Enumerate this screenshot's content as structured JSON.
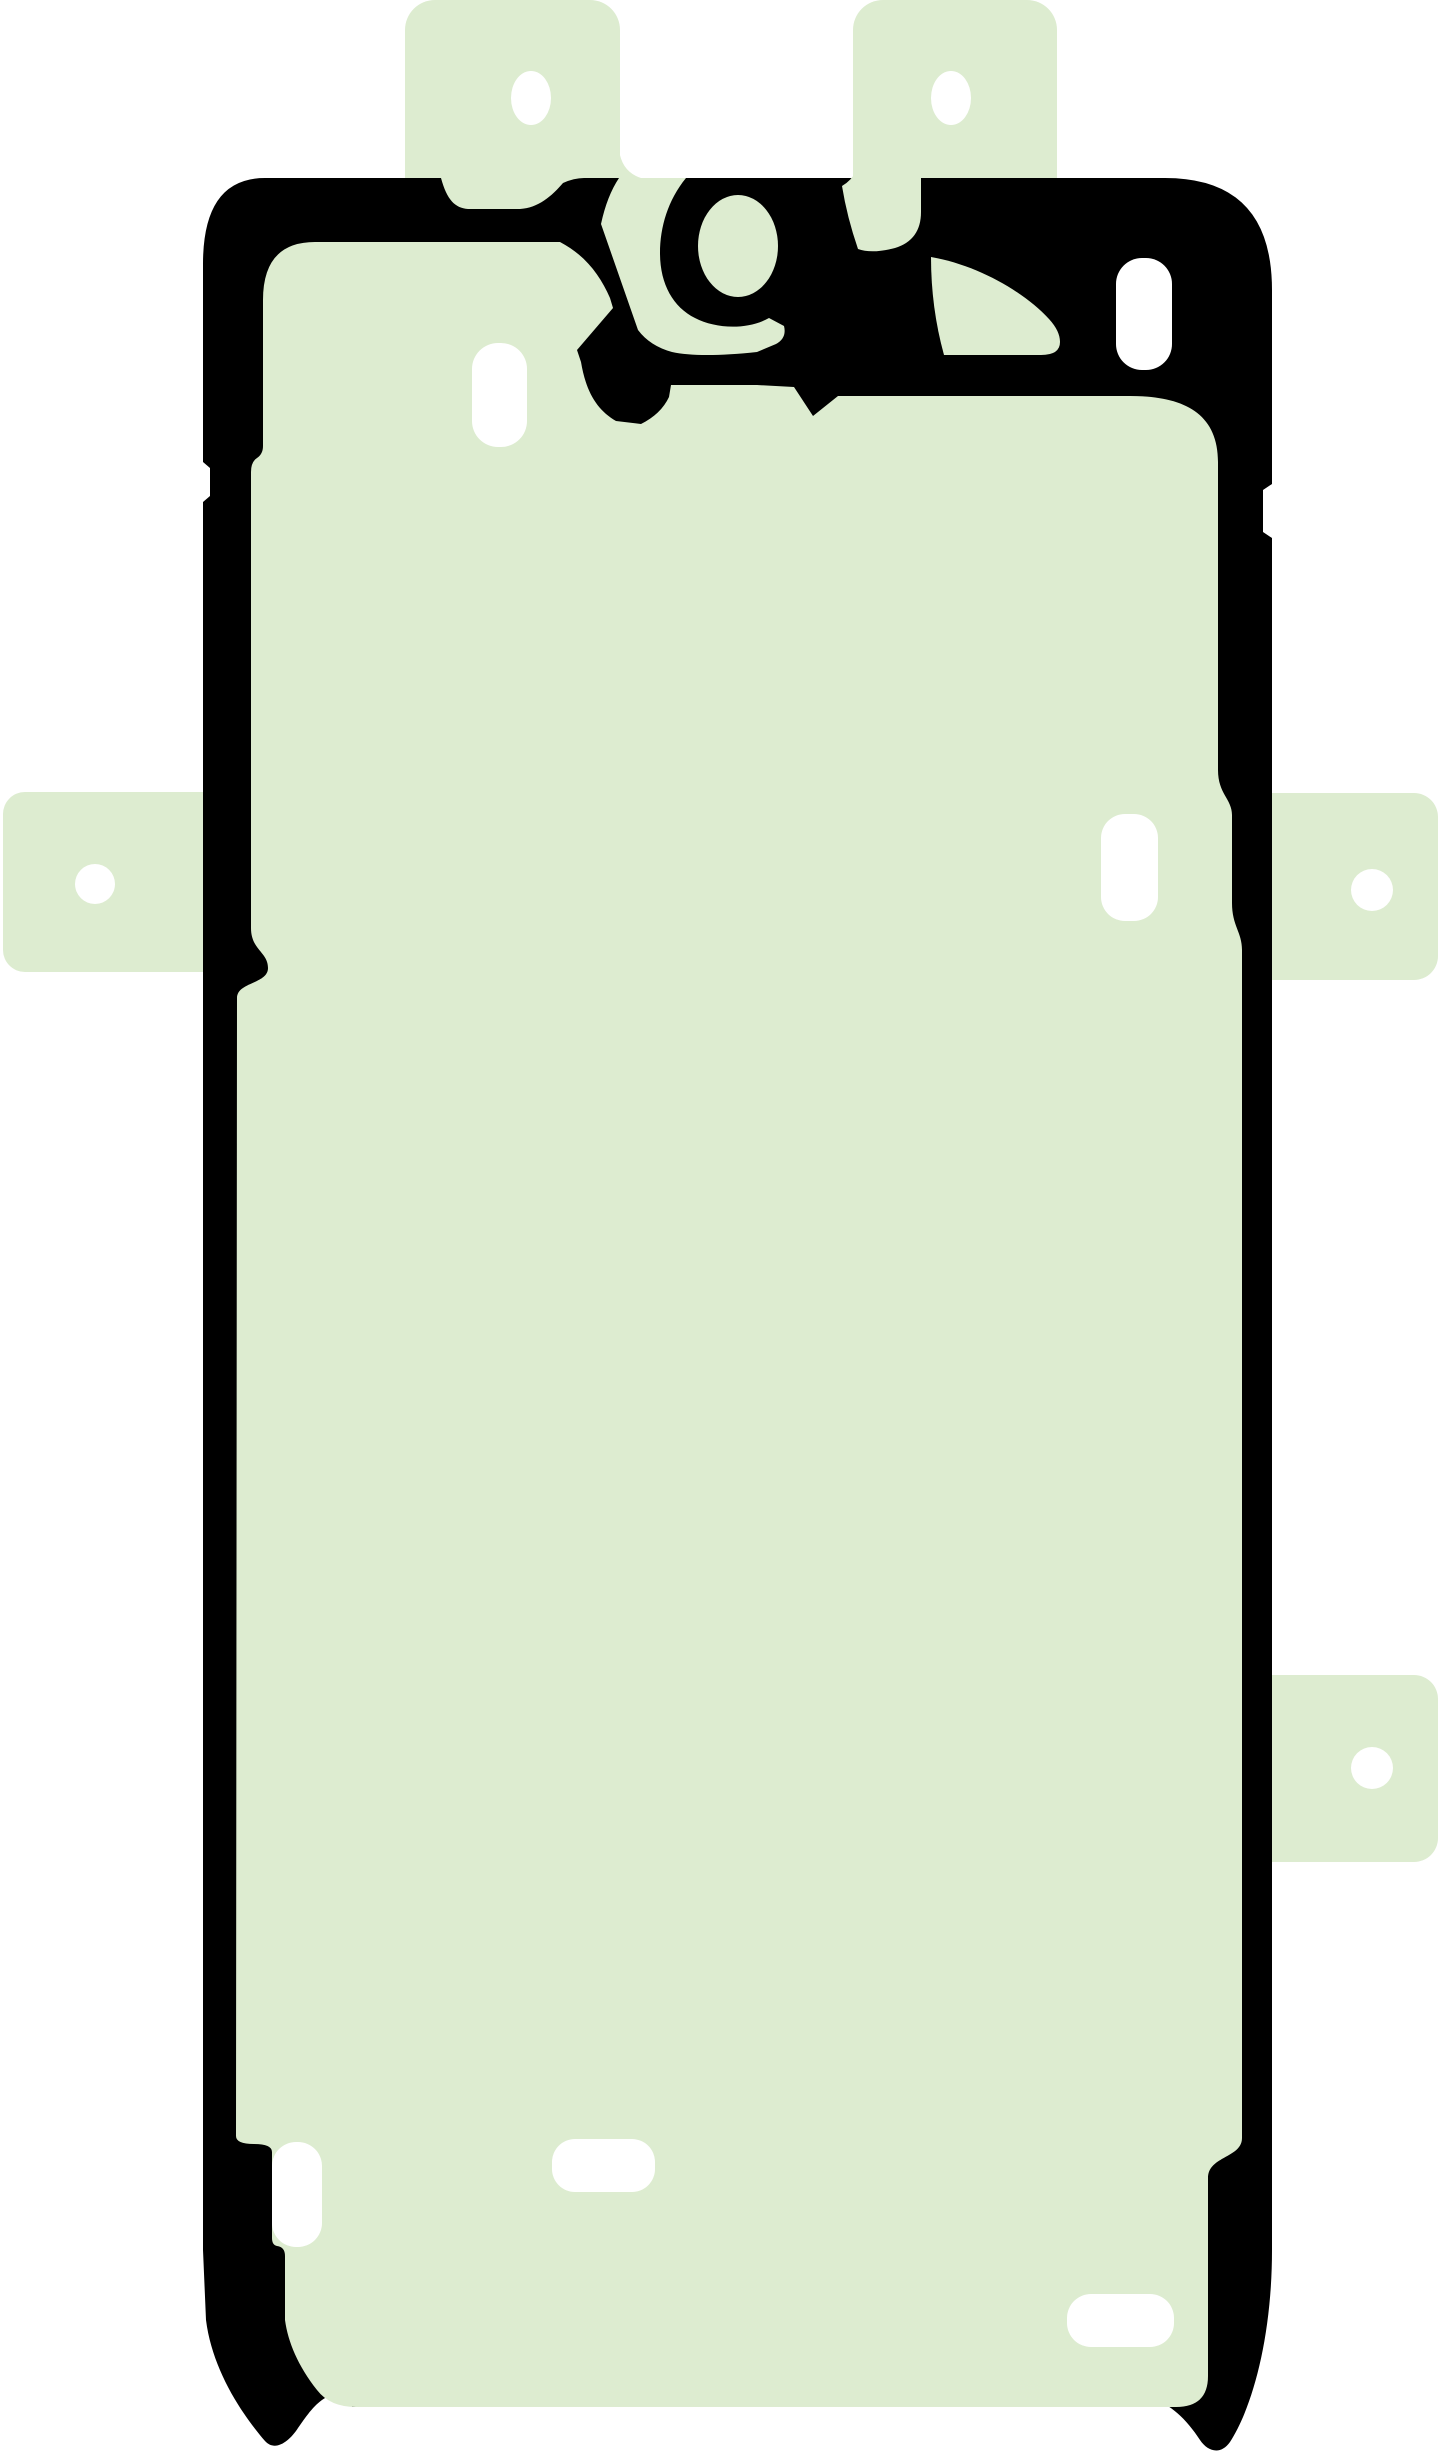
{
  "image": {
    "width": 1445,
    "height": 2452,
    "background": "#ffffff",
    "description": "Product image of a smartphone display adhesive sticker: pale green film with black gasket outline, protruding alignment tabs with punched holes, and white die-cut slots"
  },
  "colors": {
    "film_green": "#ddecd0",
    "gasket_black": "#000000",
    "cutout_white": "#ffffff"
  },
  "sticker": {
    "tabs": [
      {
        "name": "tab-top-left",
        "x": 405,
        "y": 0,
        "w": 215,
        "h": 260,
        "rx": 30
      },
      {
        "name": "tab-top-right",
        "x": 853,
        "y": 0,
        "w": 204,
        "h": 260,
        "rx": 30
      },
      {
        "name": "tab-left-middle",
        "x": 3,
        "y": 792,
        "w": 250,
        "h": 180,
        "rx": 22
      },
      {
        "name": "tab-right-middle",
        "x": 1232,
        "y": 793,
        "w": 206,
        "h": 187,
        "rx": 24
      },
      {
        "name": "tab-right-lower",
        "x": 1232,
        "y": 1675,
        "w": 206,
        "h": 187,
        "rx": 24
      }
    ],
    "tab_holes": [
      {
        "name": "hole-top-left",
        "cx": 531,
        "cy": 98,
        "rx": 20,
        "ry": 27
      },
      {
        "name": "hole-top-right",
        "cx": 951,
        "cy": 98,
        "rx": 20,
        "ry": 27
      },
      {
        "name": "hole-left-middle",
        "cx": 95,
        "cy": 884,
        "rx": 20,
        "ry": 20
      },
      {
        "name": "hole-right-middle",
        "cx": 1372,
        "cy": 890,
        "rx": 21,
        "ry": 21
      },
      {
        "name": "hole-right-lower",
        "cx": 1372,
        "cy": 1768,
        "rx": 21,
        "ry": 21
      }
    ],
    "silhouette_path": "M 203 264 Q 203 178 265 178 L 441 178 C 447 200 455 208 468 209 L 520 209 C 538 208 552 196 563 183 Q 574 178 584 178 L 1165 178 Q 1272 178 1272 290 L 1272 484 L 1263 490 L 1263 532 L 1272 538 L 1272 2250 C 1272 2338 1252 2408 1230 2442 C 1221 2455 1208 2452 1200 2440 C 1187 2420 1170 2403 1150 2398 Q 1139 2396 1139 2407 L 352 2407 Q 352 2397 341 2395 C 324 2392 311 2409 298 2428 C 289 2442 275 2452 265 2441 C 240 2412 212 2368 206 2320 L 203 2250 L 203 502 L 210 496 L 210 468 L 203 462 Z",
    "film_panel_path": "M 263 300 Q 263 242 315 242 L 560 242 C 585 255 600 275 610 298 L 613 308 L 577 350 L 581 362 C 586 392 597 410 616 421 L 641 424 Q 661 414 669 397 L 671 385 L 757 385 L 794 387 L 813 416 L 838 396 L 1130 396 C 1182 396 1218 412 1218 462 L 1218 770 C 1218 794 1232 799 1232 815 L 1232 903 C 1232 926 1242 932 1242 950 L 1242 2138 C 1242 2158 1208 2156 1208 2178 L 1208 2376 Q 1208 2407 1176 2407 L 356 2407 Q 330 2407 317 2390 C 298 2366 288 2342 285 2320 L 285 2256 Q 285 2247 277 2246 Q 272 2245 272 2238 L 272 2152 Q 272 2144 254 2144 Q 236 2144 236 2136 L 237 998 C 237 982 268 984 268 968 C 268 952 251 950 251 928 L 251 472 Q 251 462 257 458 Q 263 454 263 446 Z",
    "detail_green_paths": [
      {
        "name": "camera-loop-surround",
        "d": "M 619 150 Q 622 172 641 178 L 686 178 C 668 200 660 227 660 253 C 660 284 673 307 695 318 C 716 329 748 330 769 318 L 784 326 Q 787 338 776 344 L 757 352 Q 700 358 672 352 Q 650 346 638 330 L 601 224 Q 607 196 619 178 Z"
      },
      {
        "name": "under-tab-right-pocket",
        "d": "M 857 150 L 921 150 L 921 212 Q 921 240 895 248 Q 872 254 858 249 Q 847 217 842 186 Q 851 181 857 170 Z"
      },
      {
        "name": "upper-right-pocket",
        "d": "M 931 257 C 977 265 1023 291 1049 319 Q 1060 331 1060 342 Q 1060 355 1041 355 L 944 355 Q 931 308 931 257 Z"
      }
    ],
    "camera_loop_interior": {
      "name": "camera-loop-interior",
      "cx": 738,
      "cy": 246,
      "rx": 40,
      "ry": 51
    },
    "white_cutouts": [
      {
        "name": "slot-upper-left",
        "x": 472,
        "y": 343,
        "w": 55,
        "h": 104,
        "rx": 26
      },
      {
        "name": "slot-upper-right",
        "x": 1116,
        "y": 258,
        "w": 56,
        "h": 112,
        "rx": 26
      },
      {
        "name": "slot-right-middle",
        "x": 1101,
        "y": 814,
        "w": 57,
        "h": 107,
        "rx": 24
      },
      {
        "name": "slot-lower-left",
        "x": 272,
        "y": 2142,
        "w": 50,
        "h": 105,
        "rx": 24
      },
      {
        "name": "slot-bottom-center",
        "x": 552,
        "y": 2139,
        "w": 103,
        "h": 53,
        "rx": 23
      },
      {
        "name": "slot-bottom-right",
        "x": 1067,
        "y": 2294,
        "w": 107,
        "h": 53,
        "rx": 24
      }
    ]
  }
}
